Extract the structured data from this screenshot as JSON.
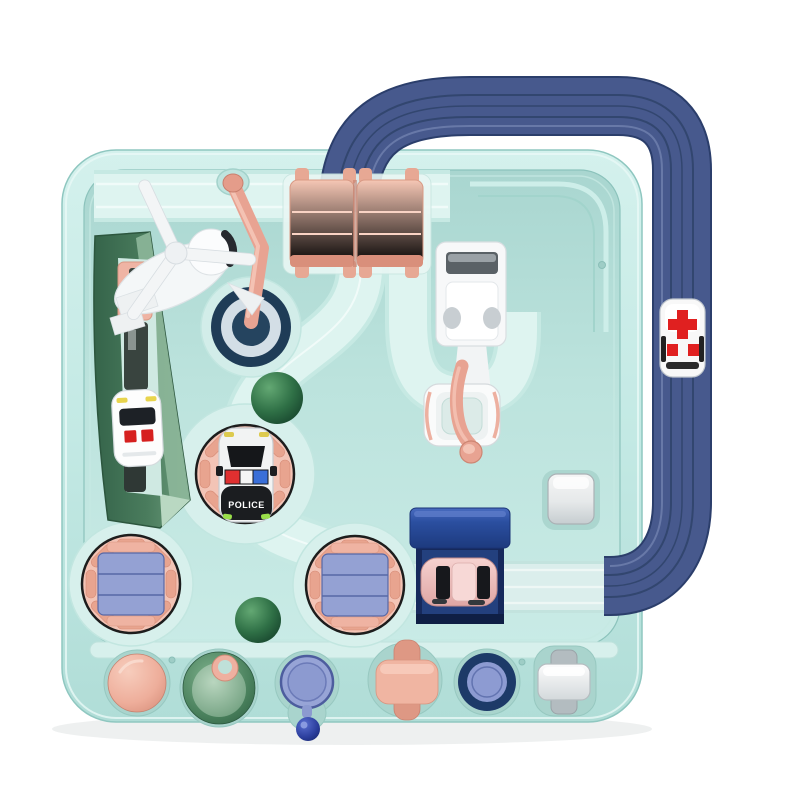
{
  "scene": {
    "description": "Top-down product photo of a children's car adventure rail-track toy board in mint green, with a navy overhead tube track loop, pink flip bridge, rotating turntables, a green launch ramp, rescue vehicles and a row of colorful action buttons along the bottom edge.",
    "labels": {
      "police_text": "POLICE"
    },
    "vehicles": [
      {
        "id": "police-car",
        "color": "white-black",
        "marking": "POLICE"
      },
      {
        "id": "ambulance",
        "color": "white",
        "marking": "red cross"
      },
      {
        "id": "white-train",
        "color": "white",
        "marking": "red squares"
      },
      {
        "id": "pink-car",
        "color": "pink"
      },
      {
        "id": "white-car",
        "color": "white"
      },
      {
        "id": "helicopter",
        "color": "white"
      }
    ],
    "buttons": [
      {
        "id": "pink-dome-button",
        "color": "#eeae9b"
      },
      {
        "id": "green-cone-button",
        "color": "#7ca889"
      },
      {
        "id": "pendulum-button",
        "color": "#94a1d3"
      },
      {
        "id": "pink-cross-button",
        "color": "#f0b5a2"
      },
      {
        "id": "navy-ring-button",
        "color": "#1d3a68"
      },
      {
        "id": "white-slider-button",
        "color": "#f4f5f5"
      }
    ],
    "palette": {
      "board_mint": "#c3e9e4",
      "panel_mint": "#b5dfd9",
      "track_light": "#def4f0",
      "tube_navy": "#47598d",
      "salmon_pink": "#eeae9b",
      "turntable_pink": "#f3c4b6",
      "periwinkle": "#94a1d3",
      "navy_dark": "#1d3a68",
      "ramp_green": "#4a7c5d",
      "dome_green": "#2f7046",
      "alert_red": "#e02020",
      "royal_blue": "#2b4fa0"
    }
  }
}
